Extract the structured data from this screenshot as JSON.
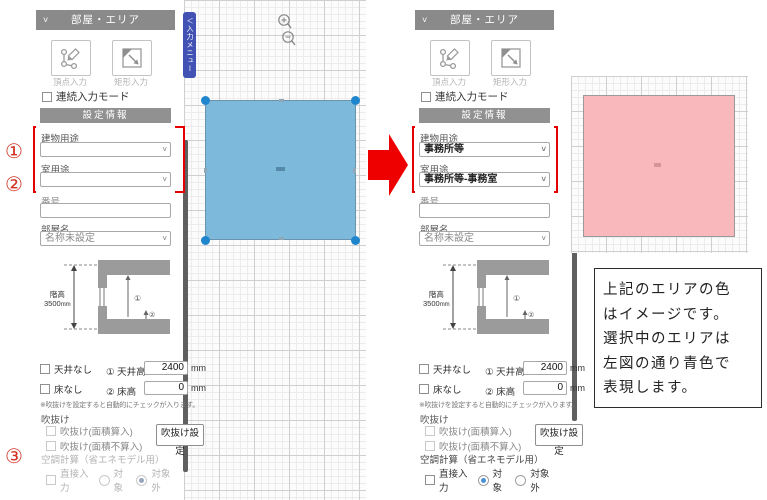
{
  "panel": {
    "title": "部屋・エリア",
    "collapse_chevron": "˅",
    "vertex_input": "頂点入力",
    "rect_input": "矩形入力",
    "continuous": "連続入力モード",
    "settings": "設定情報",
    "building_use": "建物用途",
    "room_use": "室用途",
    "number": "番号",
    "room_name": "部屋名",
    "room_name_value": "名称未設定",
    "floor_height_label": "階高",
    "floor_height_value": "3500",
    "unit_mm": "mm",
    "marker1": "①",
    "marker2": "②",
    "no_ceiling": "天井なし",
    "ceiling_height": "① 天井高",
    "ceiling_height_value": "2400",
    "no_floor": "床なし",
    "floor_h": "② 床高",
    "floor_h_value": "0",
    "note": "※吹抜けを設定すると自動的にチェックが入ります。",
    "void_title": "吹抜け",
    "void_opt1": "吹抜け(面積算入)",
    "void_opt2": "吹抜け(面積不算入)",
    "void_button": "吹抜け設定",
    "aircon_title": "空調計算（省エネモデル用）",
    "direct_input": "直接入力",
    "target": "対象",
    "not_target": "対象外"
  },
  "left": {
    "building_use_value": "",
    "room_use_value": ""
  },
  "right": {
    "building_use_value": "事務所等",
    "room_use_value": "事務所等-事務室"
  },
  "markers": {
    "n1": "①",
    "n2": "②",
    "n3": "③"
  },
  "canvas": {
    "menu_tab_chevron": "＜",
    "menu_tab": "入力メニュー"
  },
  "note_box": {
    "lines": [
      "上記のエリアの色",
      "はイメージです。",
      "選択中のエリアは",
      "左図の通り青色で",
      "表現します。"
    ]
  },
  "colors": {
    "accent_red": "#e50000",
    "area_blue": "#7db9da",
    "area_pink": "#f9b8bc",
    "handle_blue": "#1f86ce",
    "tab_blue": "#4152b4",
    "header_gray": "#8a8a8a"
  }
}
